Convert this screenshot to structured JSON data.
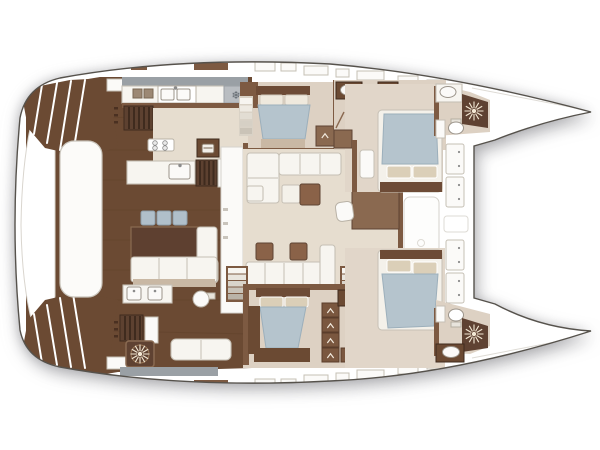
{
  "app": {
    "type": "catamaran-yacht-deck-plan",
    "visible_text": []
  },
  "palette": {
    "pagebg": "#ffffff",
    "hull": "#ffffff",
    "outline": "#56524c",
    "deck": "#6b4a33",
    "wall": "#7d5a42",
    "headboard": "#6d4b36",
    "woodmid": "#8a6950",
    "woodred": "#8a6248",
    "wooddark": "#5f4433",
    "slat": "#5d4130",
    "slatdark": "#3f2b1e",
    "shower": "#5f4232",
    "cream": "#e6ddcf",
    "cabinfloor": "#ddd1c3",
    "fwdfloor": "#e1d6c9",
    "white": "#f7f5f0",
    "bright": "#fbfaf8",
    "border": "#c6c0b5",
    "sinkline": "#9b948a",
    "duvet": "#b5c4cd",
    "duvetline": "#9cafbb",
    "pillow": "#dbcfb8",
    "grayband": "#9aa0a5",
    "graybox": "#b9bdc1",
    "stool": "#b0bfca",
    "stoolline": "#8fa0ac",
    "tan": "#c9b8a4",
    "tabletan": "#d6c9b0",
    "ray": "#f3e8d4",
    "faint": "#e8e6e2",
    "drawer": "#7a573f",
    "drawerline": "#5a3d2b"
  },
  "icons": {
    "snowflake": "❄"
  },
  "rooms": [
    "aft-cockpit",
    "swim-platform",
    "galley",
    "dinette",
    "salon",
    "nav-station",
    "port-mid-cabin",
    "port-mid-bathroom",
    "port-forward-cabin",
    "port-bow-bathroom",
    "starboard-lounge",
    "starboard-mid-cabin",
    "starboard-dressing",
    "starboard-forward-cabin",
    "starboard-bow-bathroom",
    "foredeck",
    "trampoline"
  ],
  "fixtures": [
    "double-sink",
    "cooktop",
    "oven",
    "freezer",
    "washbasin",
    "shower",
    "toilet",
    "stairs",
    "companionway",
    "deck-hatch",
    "windlass",
    "bed",
    "sofa",
    "settee",
    "stool",
    "coffee-table",
    "dining-table",
    "vanity",
    "sunpad",
    "drawers",
    "wardrobe"
  ]
}
